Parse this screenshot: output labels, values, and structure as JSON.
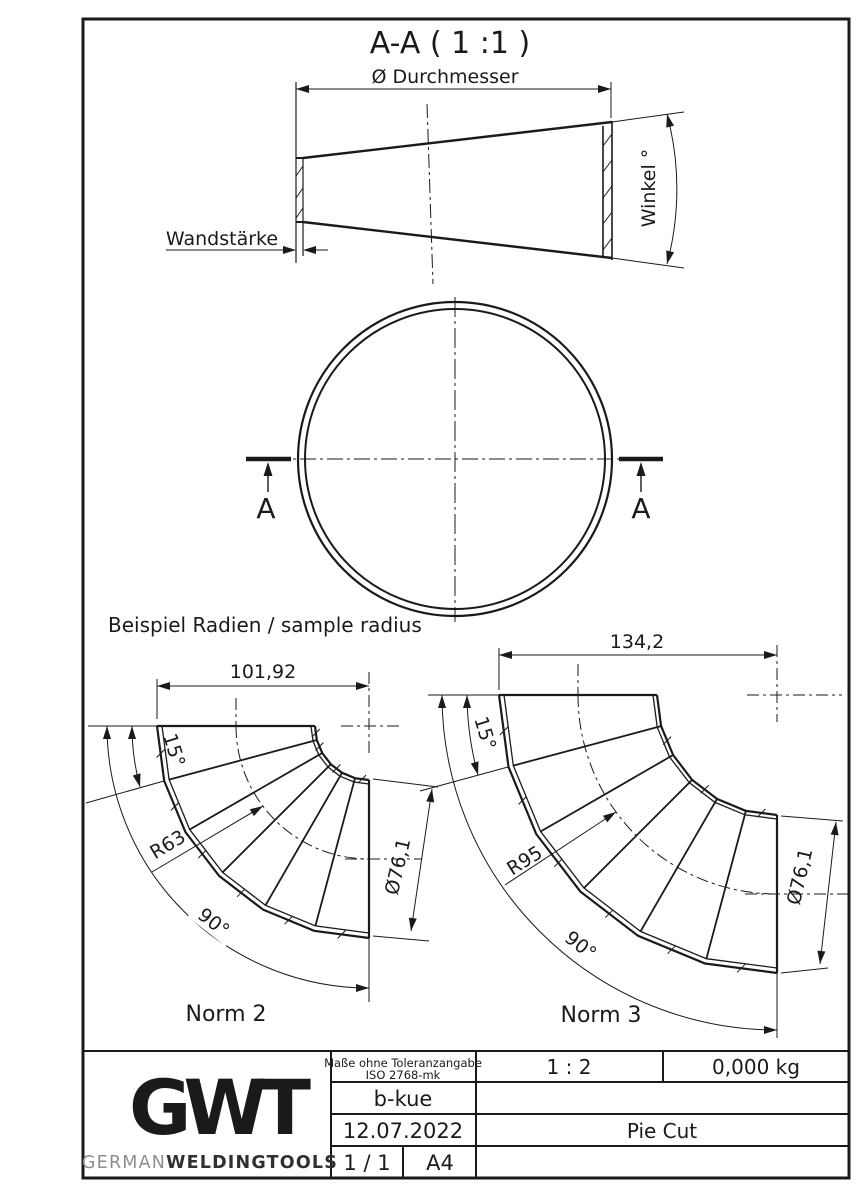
{
  "drawing": {
    "section_title": "A-A ( 1 :1 )",
    "cone": {
      "diameter_label": "Ø Durchmesser",
      "wall_label": "Wandstärke",
      "angle_label": "Winkel °"
    },
    "section_marks": {
      "left": "A",
      "right": "A"
    },
    "examples": {
      "heading": "Beispiel Radien / sample radius",
      "norm2": {
        "name": "Norm 2",
        "width": "101,92",
        "segment_angle": "15°",
        "radius": "R63",
        "total_angle": "90°",
        "diameter": "Ø76,1"
      },
      "norm3": {
        "name": "Norm 3",
        "width": "134,2",
        "segment_angle": "15°",
        "radius": "R95",
        "total_angle": "90°",
        "diameter": "Ø76,1"
      }
    }
  },
  "title_block": {
    "tolerance_line1": "Maße ohne Toleranzangabe",
    "tolerance_line2": "ISO 2768-mk",
    "scale": "1 : 2",
    "weight": "0,000 kg",
    "author": "b-kue",
    "date": "12.07.2022",
    "part_name": "Pie Cut",
    "sheet": "1 / 1",
    "format": "A4",
    "logo_text": "GWT",
    "brand_gray": "GERMAN",
    "brand_bold": "WELDINGTOOLS"
  },
  "colors": {
    "line": "#1a1a1a",
    "background": "#ffffff",
    "logo_dark": "#3b3b3b",
    "logo_mid": "#5c5c5c",
    "brand_gray": "#8e8e8e",
    "brand_dark": "#303030"
  }
}
